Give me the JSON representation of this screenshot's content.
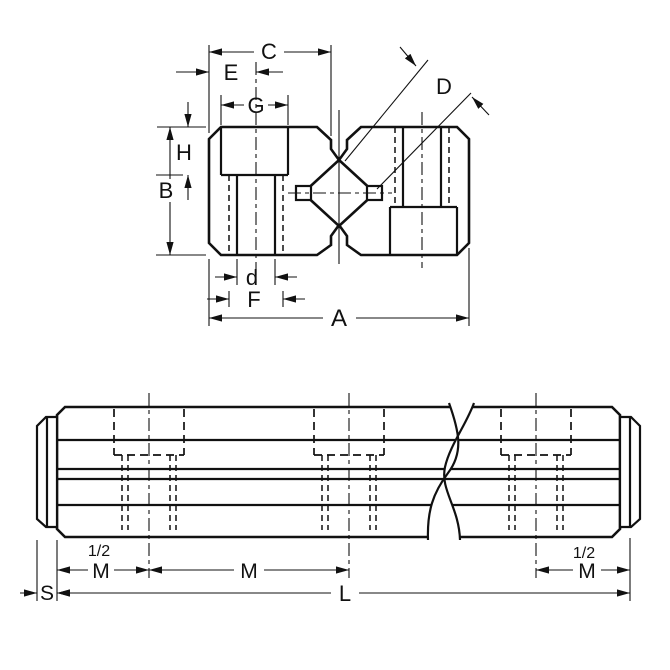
{
  "drawing": {
    "type": "technical dimension drawing",
    "background_color": "#ffffff",
    "line_color": "#111111",
    "top_view": {
      "description": "end cross-section view of dual shaft rail with two chamfered blocks, counterbored mounting holes and diamond rail profile",
      "dim_labels": {
        "A": "A",
        "B": "B",
        "C": "C",
        "D": "D",
        "E": "E",
        "F": "F",
        "G": "G",
        "H": "H",
        "d": "d"
      }
    },
    "side_view": {
      "description": "side elevation of long rail with end caps, three hidden mounting holes and break symbol",
      "dim_labels": {
        "half_left": "1/2",
        "m_left": "M",
        "m_mid": "M",
        "half_right": "1/2",
        "m_right": "M",
        "s": "S",
        "l": "L"
      }
    }
  }
}
